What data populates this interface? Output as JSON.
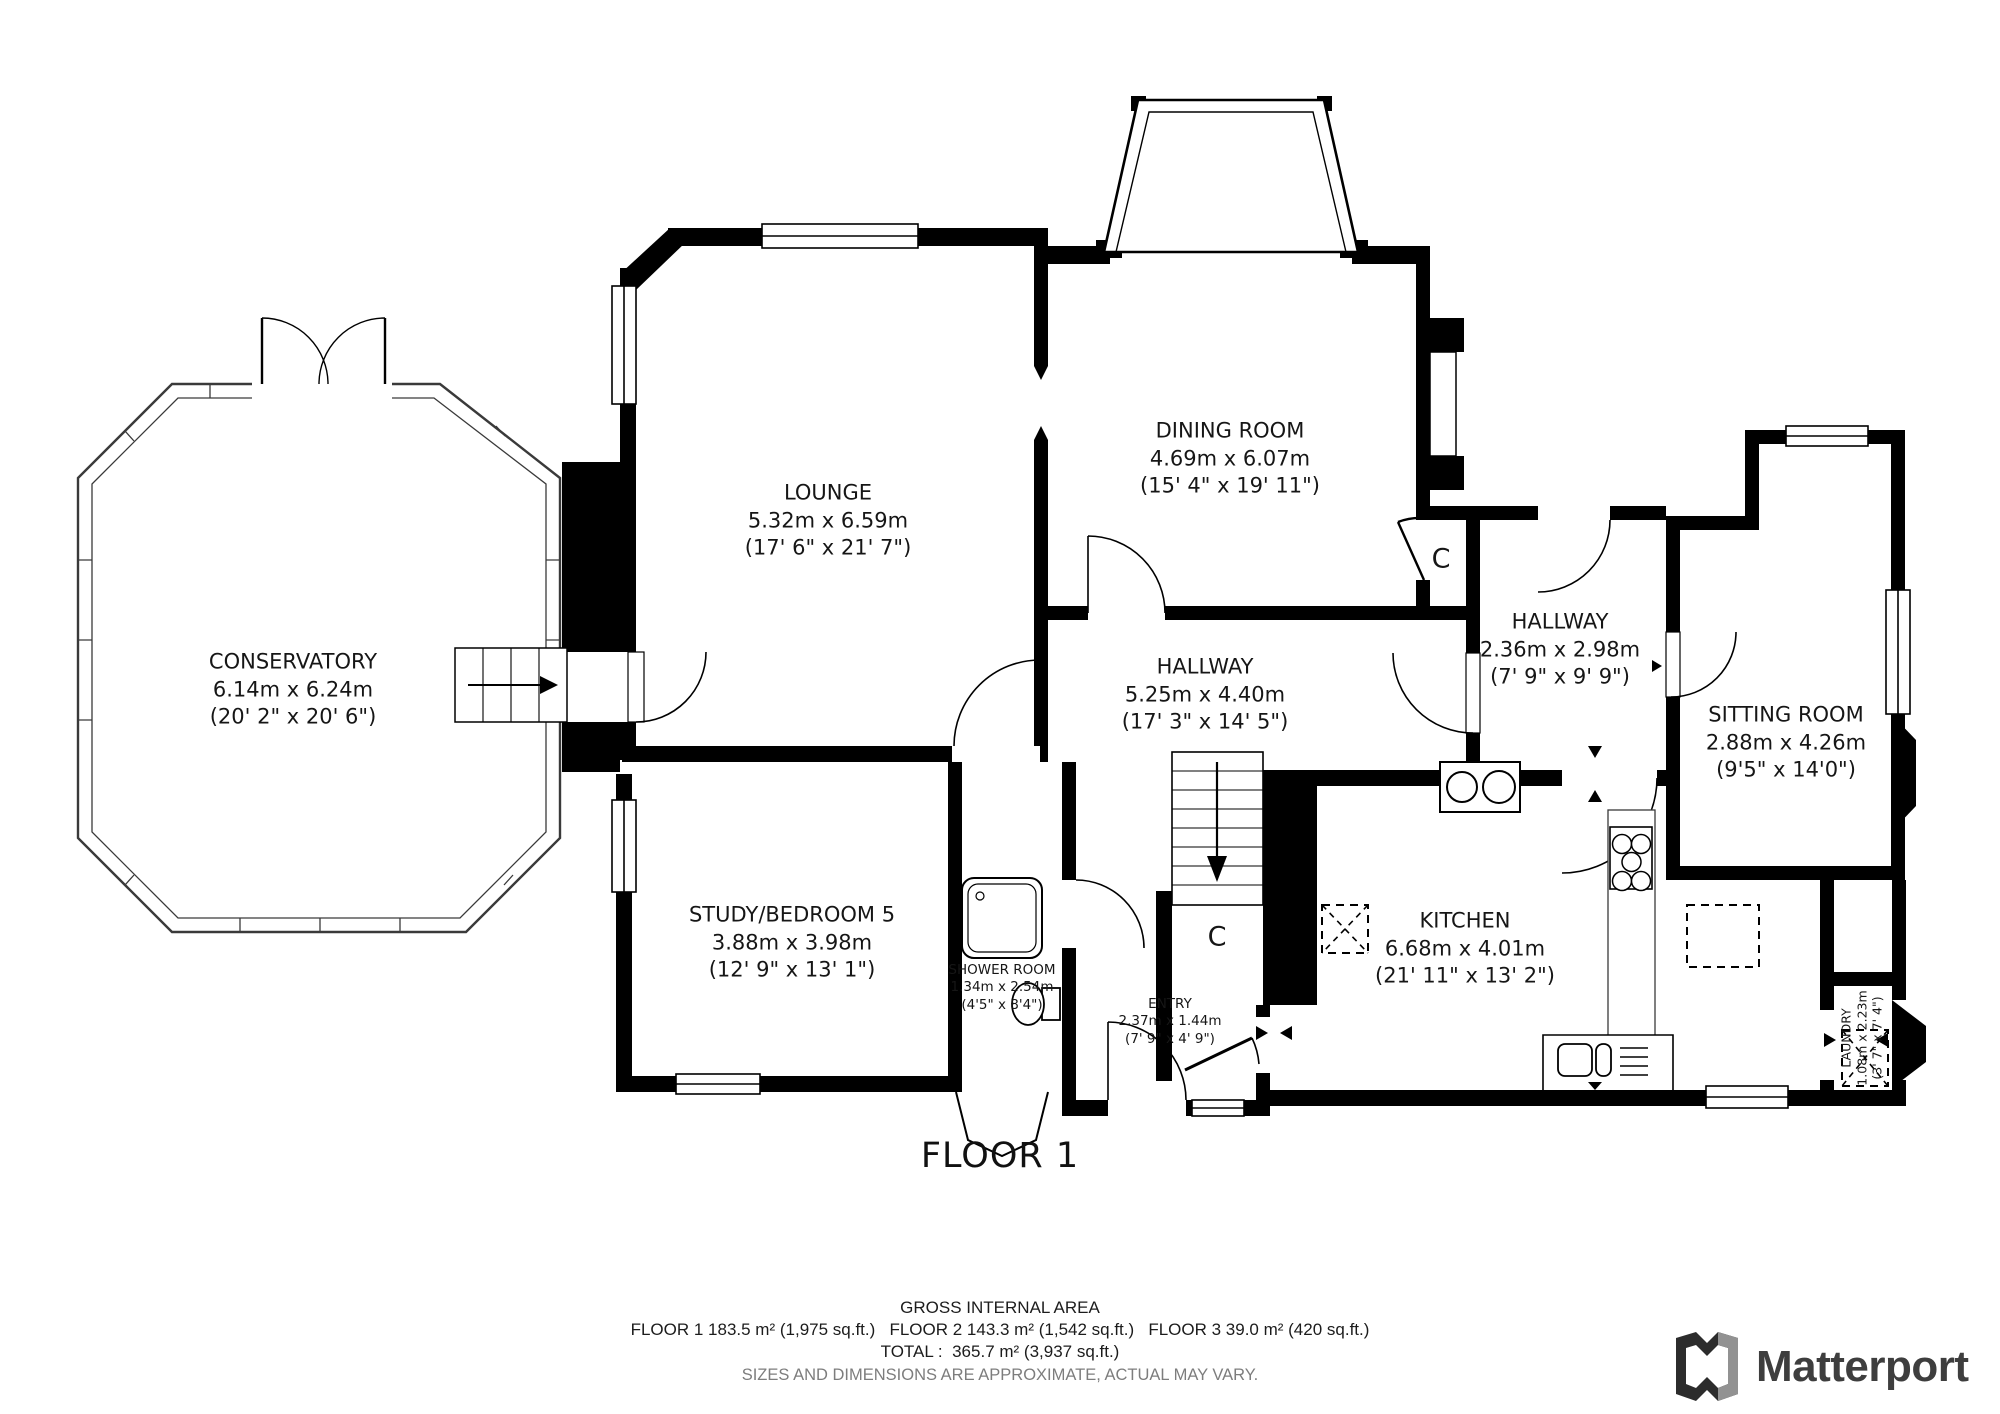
{
  "floor_label": "FLOOR 1",
  "closet_label": "C",
  "rooms": {
    "conservatory": {
      "name": "CONSERVATORY",
      "metric": "6.14m x 6.24m",
      "imperial": "(20' 2\" x 20' 6\")"
    },
    "lounge": {
      "name": "LOUNGE",
      "metric": "5.32m x 6.59m",
      "imperial": "(17' 6\" x 21' 7\")"
    },
    "dining_room": {
      "name": "DINING ROOM",
      "metric": "4.69m x 6.07m",
      "imperial": "(15' 4\" x 19' 11\")"
    },
    "hallway_main": {
      "name": "HALLWAY",
      "metric": "5.25m x 4.40m",
      "imperial": "(17' 3\" x 14' 5\")"
    },
    "hallway_rear": {
      "name": "HALLWAY",
      "metric": "2.36m x 2.98m",
      "imperial": "(7' 9\" x 9' 9\")"
    },
    "sitting_room": {
      "name": "SITTING ROOM",
      "metric": "2.88m x 4.26m",
      "imperial": "(9'5\" x 14'0\")"
    },
    "study": {
      "name": "STUDY/BEDROOM 5",
      "metric": "3.88m x 3.98m",
      "imperial": "(12' 9\" x 13' 1\")"
    },
    "shower_room": {
      "name": "SHOWER ROOM",
      "metric": "1.34m x 2.54m",
      "imperial": "(4'5\" x 8'4\")"
    },
    "entry": {
      "name": "ENTRY",
      "metric": "2.37m x 1.44m",
      "imperial": "(7' 9\" x 4' 9\")"
    },
    "kitchen": {
      "name": "KITCHEN",
      "metric": "6.68m x 4.01m",
      "imperial": "(21' 11\" x 13' 2\")"
    },
    "laundry": {
      "name": "LAUNDRY",
      "metric": "1.08m x 2.23m",
      "imperial": "(3' 7\" x 7' 4\")"
    }
  },
  "footer": {
    "title": "GROSS INTERNAL AREA",
    "areas": "FLOOR 1 183.5 m² (1,975 sq.ft.)   FLOOR 2 143.3 m² (1,542 sq.ft.)   FLOOR 3 39.0 m² (420 sq.ft.)",
    "total": "TOTAL :  365.7 m² (3,937 sq.ft.)",
    "disclaimer": "SIZES AND DIMENSIONS ARE APPROXIMATE, ACTUAL MAY VARY."
  },
  "brand": {
    "name": "Matterport"
  },
  "colors": {
    "wall": "#000000",
    "outline_gray": "#3a3a3a",
    "brand_text": "#3e3e3e",
    "disclaimer_text": "#7d7d7d"
  }
}
